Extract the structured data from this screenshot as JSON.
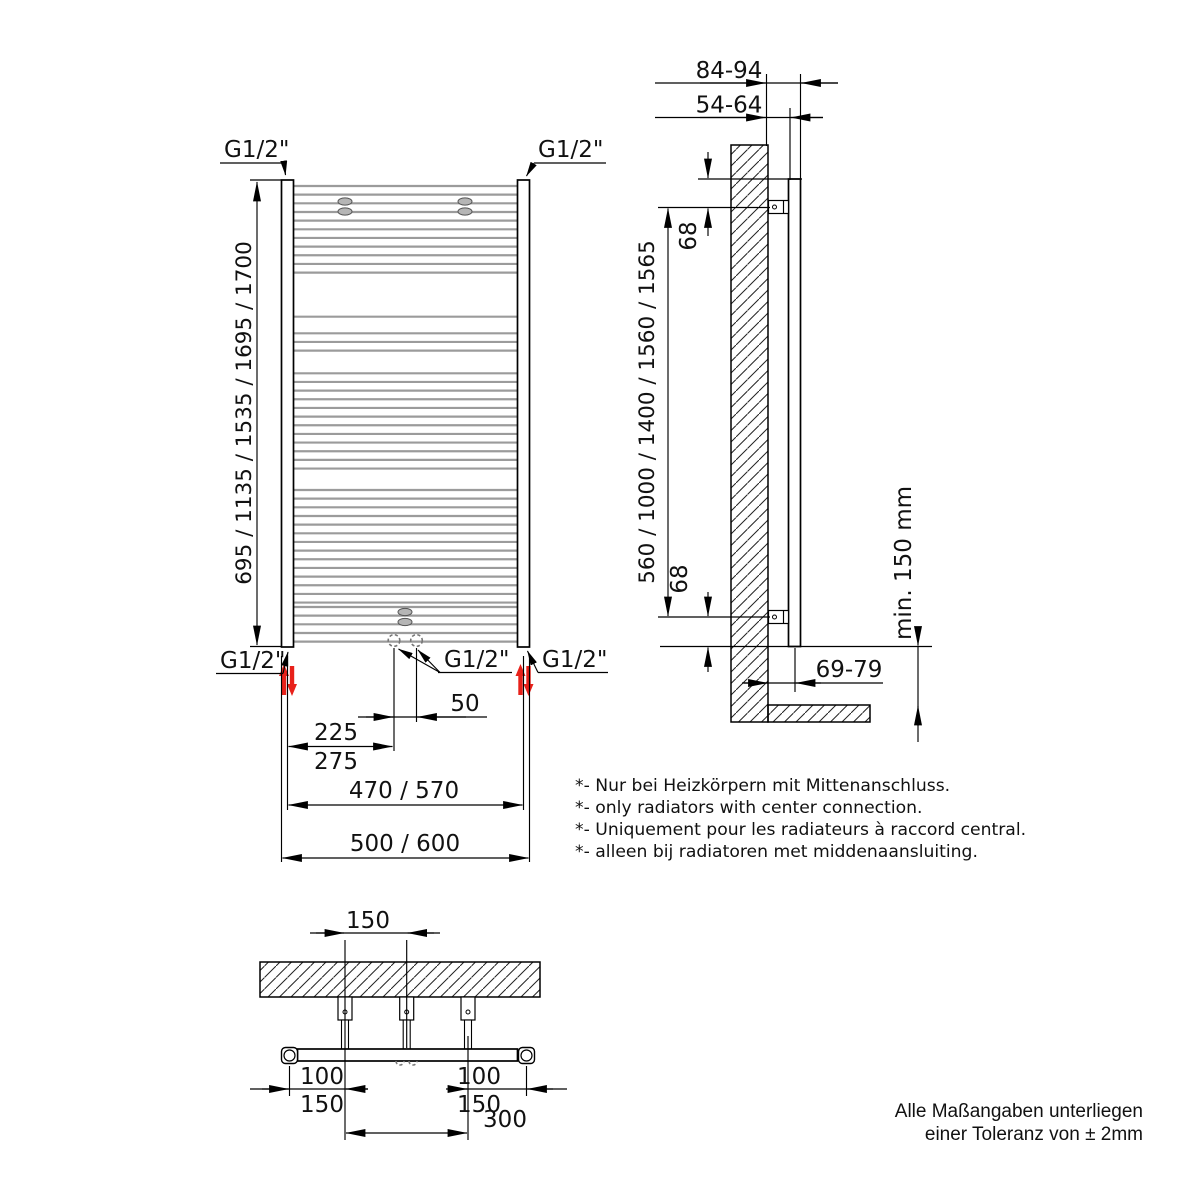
{
  "front_view": {
    "connection_label": "G1/2\"",
    "height_label": "695 / 1135 / 1535 / 1695 / 1700",
    "center_pitch_label": "50",
    "side_to_center_top": "225",
    "side_to_center_bottom": "275",
    "tube_pitch_label": "470 / 570",
    "width_label": "500 / 600",
    "rungs": {
      "x1": 293.5,
      "x2": 517.5,
      "spacing": 8.66,
      "groups": [
        [
          186,
          11
        ],
        [
          316.7,
          1
        ],
        [
          333.3,
          3
        ],
        [
          373.3,
          12
        ],
        [
          490,
          14
        ],
        [
          607,
          5
        ]
      ]
    }
  },
  "side_view": {
    "wall_to_front": "84-94",
    "wall_to_back": "54-64",
    "top_edge_to_bracket": "68",
    "bracket_span_label": "560 / 1000 / 1400 / 1560 / 1565",
    "bracket_to_bottom": "68",
    "floor_clearance": "min. 150 mm",
    "wall_to_axis": "69-79"
  },
  "bottom_view": {
    "center_bracket_offset": "150",
    "left_offset_top": "100",
    "left_offset_bottom": "150",
    "right_offset_top": "100",
    "right_offset_bottom": "150",
    "outer_bracket_span": "300"
  },
  "notes": [
    "*- Nur bei Heizkörpern mit Mittenanschluss.",
    "*- only radiators with center connection.",
    "*- Uniquement pour les radiateurs à raccord central.",
    "*- alleen bij radiatoren met middenaansluiting."
  ],
  "tolerance": [
    "Alle Maßangaben unterliegen",
    "einer Toleranz von ± 2mm"
  ],
  "colors": {
    "line": "#000000",
    "rung": "#9b9b9b",
    "red": "#e8211a"
  }
}
